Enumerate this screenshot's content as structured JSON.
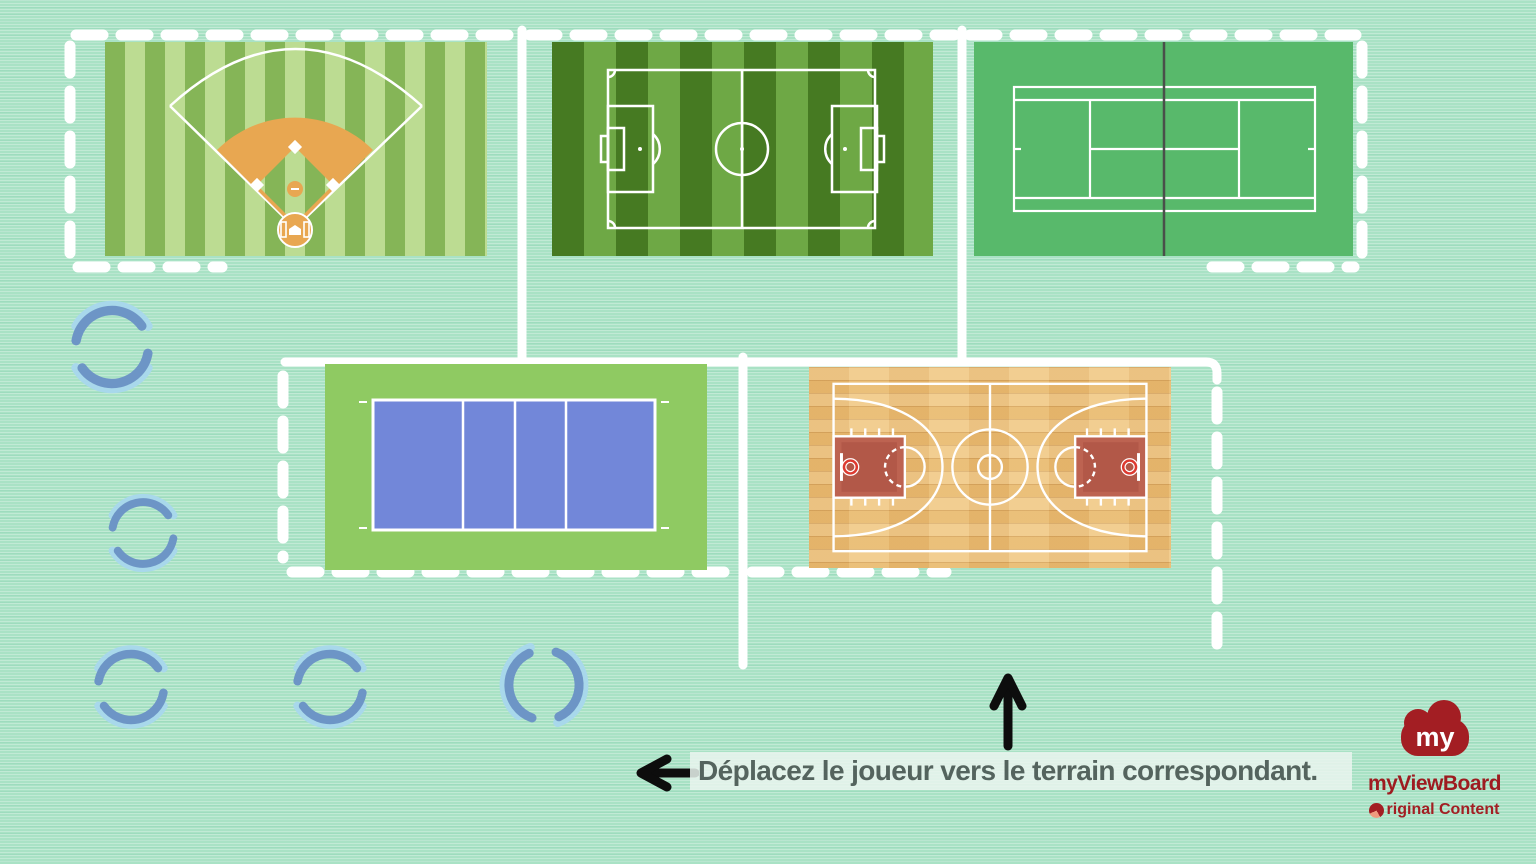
{
  "canvas": {
    "background_color": "#a9e2c5",
    "zone_line_color": "#ffffff"
  },
  "instruction": {
    "text": "Déplacez le joueur vers le terrain correspondant.",
    "text_color": "#54645e",
    "highlight_color": "#eaf5ef"
  },
  "annotations": {
    "up_arrow_icon": "up-arrow",
    "left_arrow_icon": "left-arrow",
    "arrow_color": "#0d0d0d"
  },
  "placeholders": {
    "loading_spinner_icon": "loading-spinner",
    "count": 5,
    "light_color": "#a8d8eb",
    "dark_color": "#6d95c6"
  },
  "courts": [
    {
      "id": "baseball-field",
      "stripe_light": "#bcdc92",
      "stripe_dark": "#85b557",
      "infield_color": "#e8a751",
      "line_color": "#ffffff"
    },
    {
      "id": "soccer-field",
      "stripe_light": "#6ea845",
      "stripe_dark": "#467a22",
      "line_color": "#ffffff"
    },
    {
      "id": "tennis-court",
      "surface_color": "#58b96b",
      "net_color": "#4a4f4a",
      "line_color": "#ffffff"
    },
    {
      "id": "volleyball-court",
      "surround_color": "#8fca62",
      "court_color": "#7287d9",
      "line_color": "#ffffff"
    },
    {
      "id": "basketball-court",
      "wood_color": "#ecc17a",
      "key_color": "#bd6351",
      "hoop_color": "#dd3a30",
      "line_color": "#ffffff"
    }
  ],
  "branding": {
    "cloud_text": "my",
    "wordmark": "myViewBoard",
    "content_text": "riginal Content",
    "content_o_icon": "o-disc-icon",
    "brand_red": "#9e1b20",
    "accent_salmon": "#ef9a7e"
  }
}
